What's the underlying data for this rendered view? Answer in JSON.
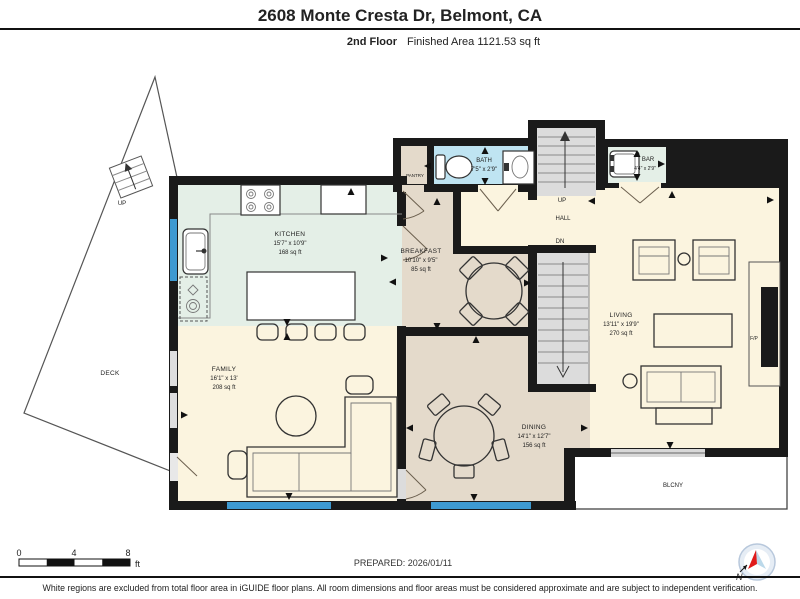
{
  "header": {
    "title": "2608 Monte Cresta Dr, Belmont, CA",
    "floor_label": "2nd Floor",
    "area_label": "Finished Area 1121.53 sq ft"
  },
  "rooms": {
    "kitchen": {
      "name": "KITCHEN",
      "dims": "15'7\" x 10'9\"",
      "area": "168 sq ft"
    },
    "breakfast": {
      "name": "BREAKFAST",
      "dims": "10'10\" x 9'5\"",
      "area": "85 sq ft"
    },
    "family": {
      "name": "FAMILY",
      "dims": "16'1\" x 13'",
      "area": "208 sq ft"
    },
    "dining": {
      "name": "DINING",
      "dims": "14'1\" x 12'7\"",
      "area": "156 sq ft"
    },
    "living": {
      "name": "LIVING",
      "dims": "13'11\" x 19'9\"",
      "area": "270 sq ft"
    },
    "bath": {
      "name": "BATH",
      "dims": "7'5\" x 2'9\""
    },
    "bar": {
      "name": "BAR",
      "dims": "4'4\" x 2'9\""
    },
    "pantry": {
      "name": "PANTRY"
    },
    "hall": {
      "name": "HALL"
    },
    "deck": {
      "name": "DECK"
    },
    "balcony": {
      "name": "BLCNY"
    },
    "fireplace": {
      "name": "F/P"
    }
  },
  "stairs": {
    "hall_up_label": "UP",
    "hall_down_label": "DN",
    "deck_up_label": "UP"
  },
  "scale_bar": {
    "ticks": [
      "0",
      "4",
      "8"
    ],
    "unit": "ft"
  },
  "footer": {
    "prepared": "PREPARED: 2026/01/11",
    "disclaimer": "White regions are excluded from total floor area in iGUIDE floor plans. All room dimensions and floor areas must be considered approximate and are subject to independent verification.",
    "compass_north": "N"
  },
  "colors": {
    "wall": "#1a1a1a",
    "cream_floor": "#fbf4df",
    "tan_floor": "#e4dacb",
    "mint_floor": "#e4efe7",
    "bath_blue": "#bfe4f2",
    "window_blue": "#3e9ad1",
    "stair_gray": "#dcdcdc",
    "compass_red": "#e01b1b",
    "compass_blue": "#bcd9ea"
  }
}
